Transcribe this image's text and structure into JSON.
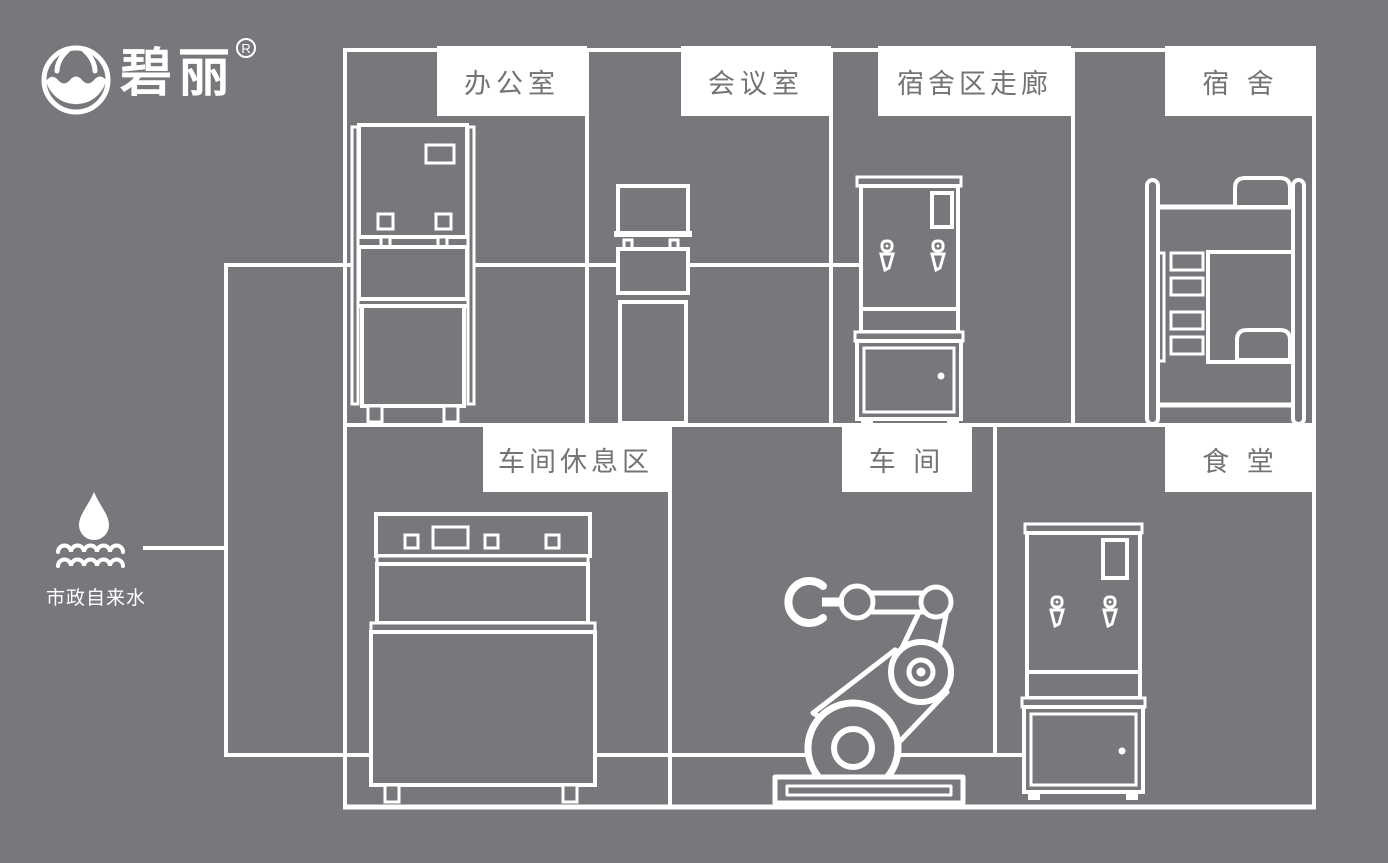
{
  "brand": {
    "name": "碧丽",
    "registered": "R"
  },
  "water_source": {
    "label": "市政自来水"
  },
  "rooms": {
    "office": {
      "label": "办公室"
    },
    "meeting": {
      "label": "会议室"
    },
    "corridor": {
      "label": "宿舍区走廊"
    },
    "dorm": {
      "label": "宿 舍"
    },
    "rest": {
      "label": "车间休息区"
    },
    "workshop": {
      "label": "车 间"
    },
    "canteen": {
      "label": "食 堂"
    }
  },
  "equipment": {
    "office": "floor-standing water dispenser",
    "meeting": "slim water dispenser",
    "corridor": "hot water boiler on cabinet",
    "dorm": "bunk bed",
    "rest": "3-tap counter water dispenser",
    "workshop": "robot arm",
    "canteen": "hot water boiler on cabinet"
  },
  "colors": {
    "background": "#77787b",
    "line": "#ffffff",
    "label_bg": "#ffffff",
    "label_text": "#737477"
  }
}
